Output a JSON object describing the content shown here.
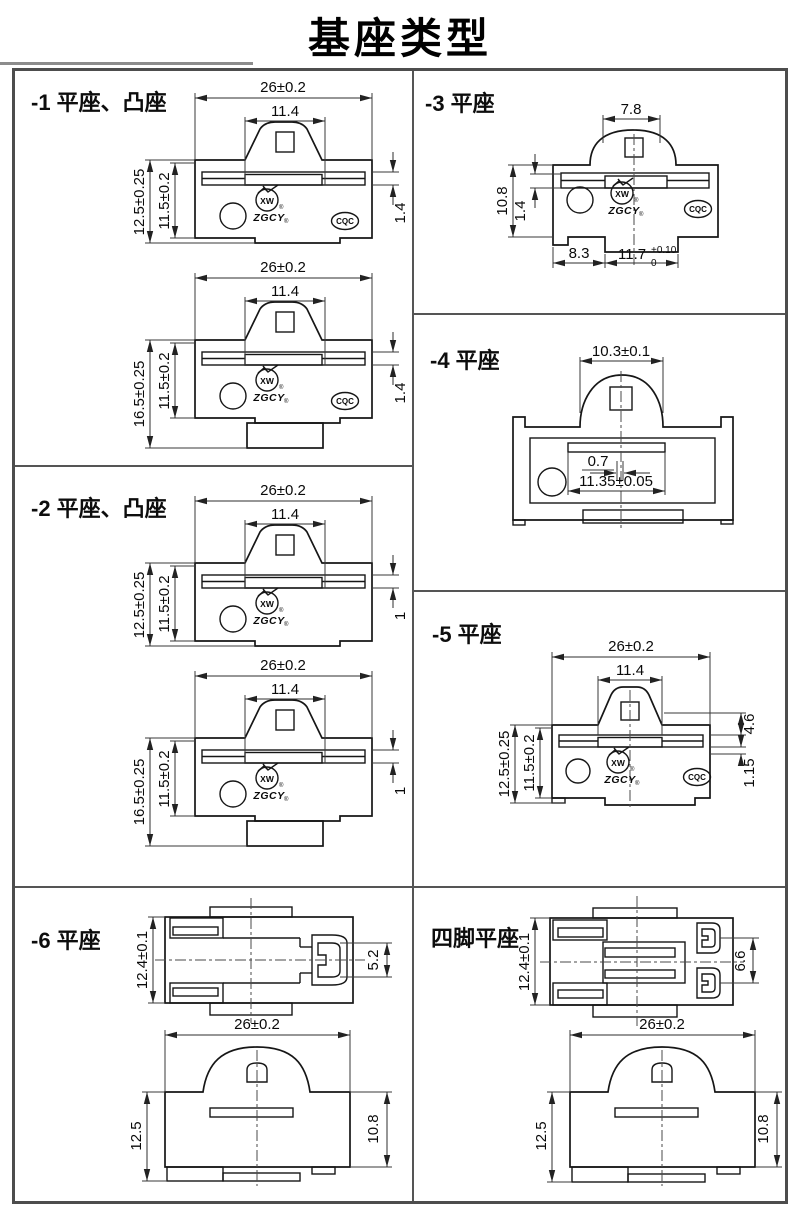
{
  "title": "基座类型",
  "logo": {
    "xw": "XW",
    "zgcy": "ZGCY",
    "reg": "®",
    "cqc": "CQC"
  },
  "panels": {
    "p1": {
      "label": "-1 平座、凸座",
      "a": {
        "w": "26±0.2",
        "iw": "11.4",
        "h": "12.5±0.25",
        "ih": "11.5±0.2",
        "r": "1.4"
      },
      "b": {
        "w": "26±0.2",
        "iw": "11.4",
        "h": "16.5±0.25",
        "ih": "11.5±0.2",
        "r": "1.4"
      }
    },
    "p2": {
      "label": "-2 平座、凸座",
      "a": {
        "w": "26±0.2",
        "iw": "11.4",
        "h": "12.5±0.25",
        "ih": "11.5±0.2",
        "r": "1"
      },
      "b": {
        "w": "26±0.2",
        "iw": "11.4",
        "h": "16.5±0.25",
        "ih": "11.5±0.2",
        "r": "1"
      }
    },
    "p3": {
      "label": "-3 平座",
      "top": "7.8",
      "h": "10.8",
      "band": "1.4",
      "bl": "8.3",
      "br": "11.7",
      "br_up": "+0.10",
      "br_dn": "0"
    },
    "p4": {
      "label": "-4 平座",
      "top": "10.3±0.1",
      "gap": "0.7",
      "inner": "11.35±0.05"
    },
    "p5": {
      "label": "-5 平座",
      "w": "26±0.2",
      "iw": "11.4",
      "h": "12.5±0.25",
      "ih": "11.5±0.2",
      "r1": "4.6",
      "r2": "1.15"
    },
    "p6": {
      "label": "-6 平座",
      "top_h": "12.4±0.1",
      "top_r": "5.2",
      "front_w": "26±0.2",
      "front_l": "12.5",
      "front_r": "10.8"
    },
    "p7": {
      "label": "四脚平座",
      "top_h": "12.4±0.1",
      "top_r": "6.6",
      "front_w": "26±0.2",
      "front_l": "12.5",
      "front_r": "10.8"
    }
  }
}
